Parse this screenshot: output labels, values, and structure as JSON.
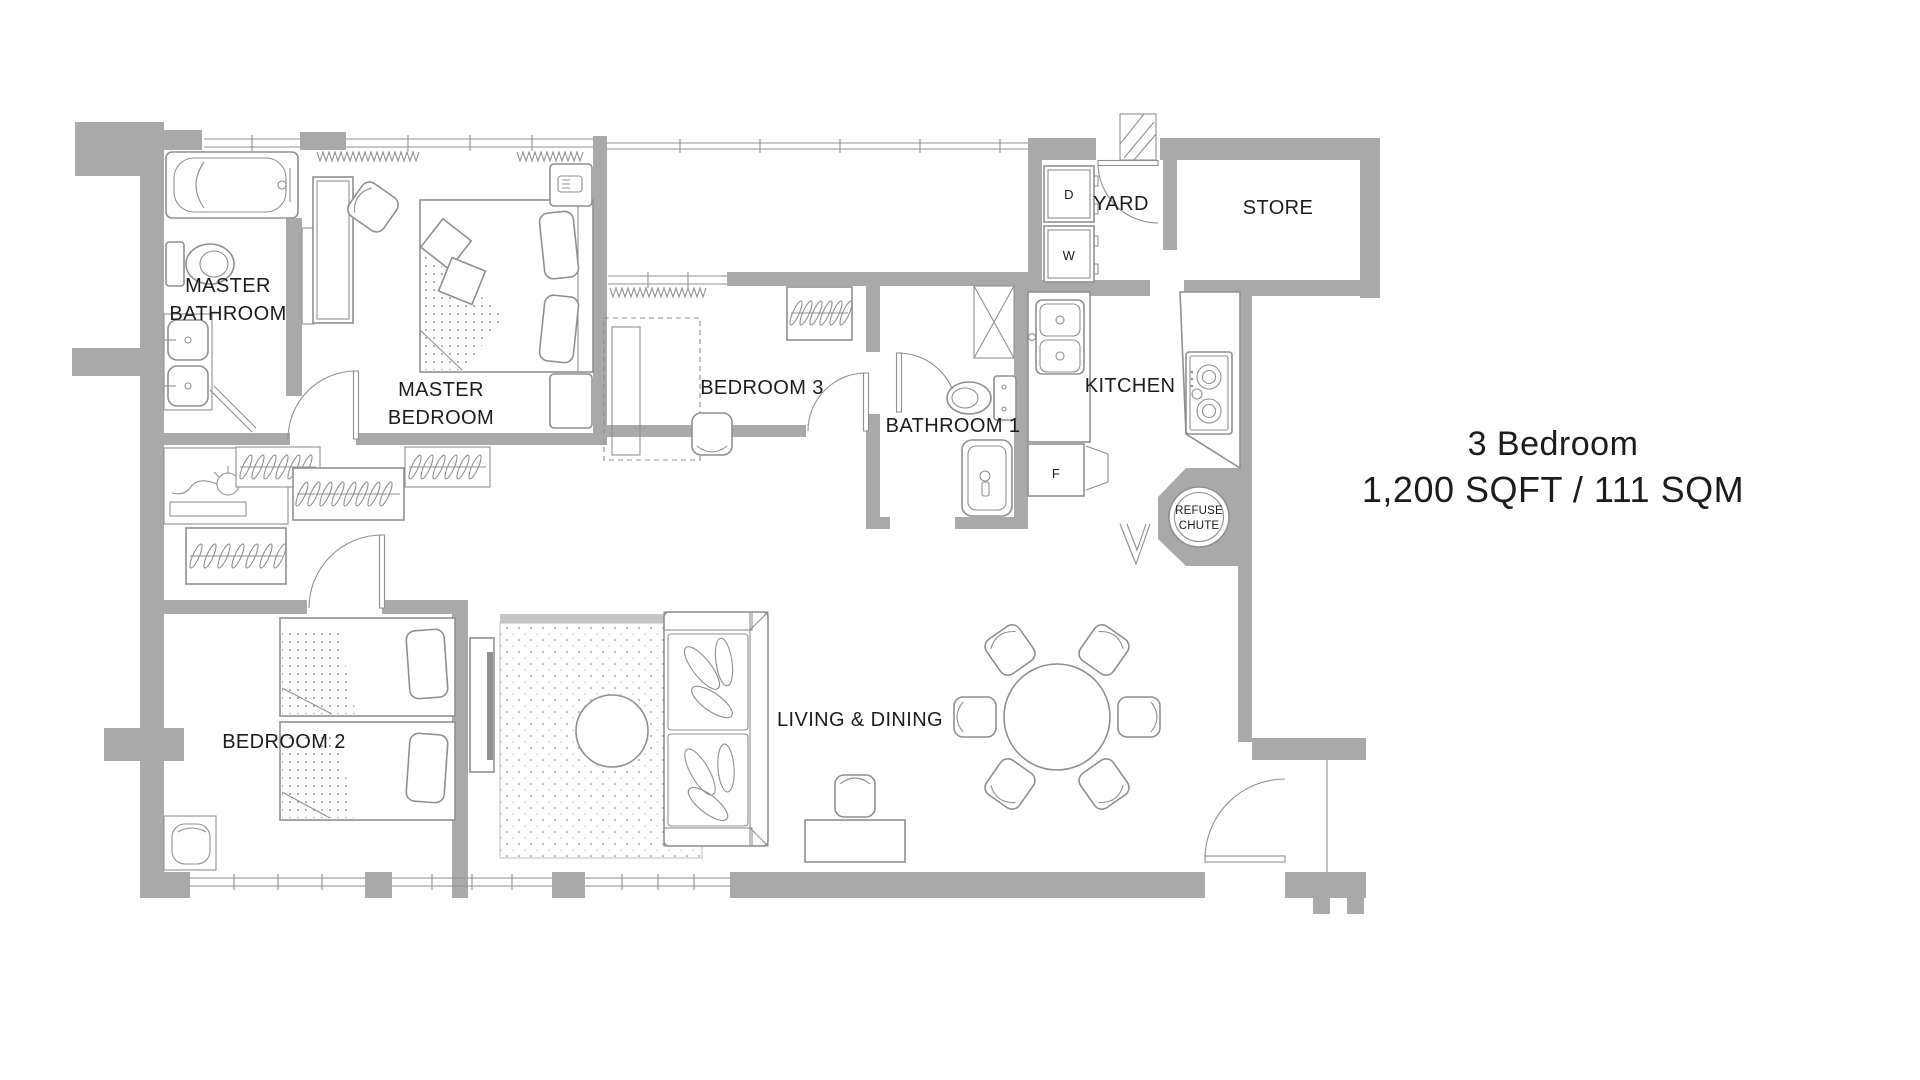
{
  "title": {
    "line1": "3 Bedroom",
    "line2": "1,200 SQFT / 111 SQM"
  },
  "rooms": {
    "master_bathroom": {
      "line1": "MASTER",
      "line2": "BATHROOM"
    },
    "master_bedroom": {
      "line1": "MASTER",
      "line2": "BEDROOM"
    },
    "bedroom_3": {
      "label": "BEDROOM 3"
    },
    "bathroom_1": {
      "label": "BATHROOM 1"
    },
    "bedroom_2": {
      "label": "BEDROOM 2"
    },
    "living_dining": {
      "label": "LIVING & DINING"
    },
    "yard": {
      "label": "YARD"
    },
    "store": {
      "label": "STORE"
    },
    "kitchen": {
      "label": "KITCHEN"
    }
  },
  "appliances": {
    "dryer": "D",
    "washer": "W",
    "fridge": "F"
  },
  "refuse_chute": {
    "line1": "REFUSE",
    "line2": "CHUTE"
  },
  "colors": {
    "wall": "#a9a9a9",
    "line": "#8f8f8f",
    "text": "#1c1c1c",
    "bg": "#ffffff"
  }
}
